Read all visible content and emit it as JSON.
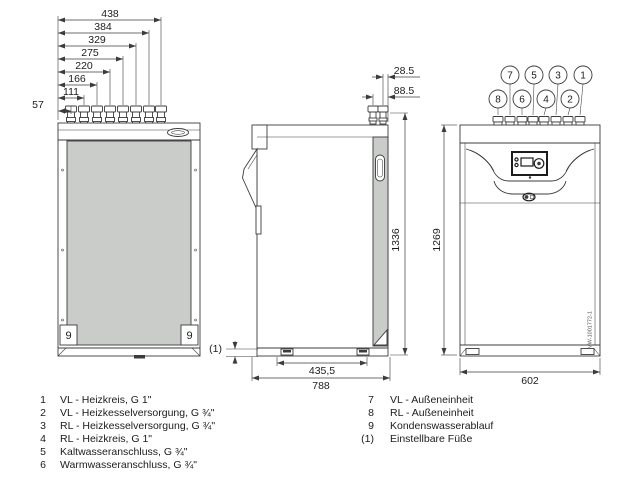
{
  "rear": {
    "dims": [
      "438",
      "384",
      "329",
      "275",
      "220",
      "166",
      "111",
      "57"
    ],
    "corner_left": "9",
    "corner_right": "9"
  },
  "side": {
    "d28": "28.5",
    "d88": "88.5",
    "height": "1336",
    "feet_width": "435,5",
    "depth": "788",
    "foot_note": "(1)"
  },
  "front": {
    "height": "1269",
    "width": "602",
    "upper_callouts": [
      "7",
      "5",
      "3",
      "1"
    ],
    "lower_callouts": [
      "8",
      "6",
      "4",
      "2"
    ],
    "drawing_number": "MW-1001772-1"
  },
  "legend": {
    "left": [
      {
        "num": "1",
        "text": "VL - Heizkreis, G 1\""
      },
      {
        "num": "2",
        "text": "VL - Heizkesselversorgung, G ¾\""
      },
      {
        "num": "3",
        "text": "RL - Heizkesselversorgung, G ¾\""
      },
      {
        "num": "4",
        "text": "RL - Heizkreis, G 1\""
      },
      {
        "num": "5",
        "text": "Kaltwasseranschluss, G ¾\""
      },
      {
        "num": "6",
        "text": "Warmwasseranschluss, G ¾\""
      }
    ],
    "right": [
      {
        "num": "7",
        "text": "VL - Außeneinheit"
      },
      {
        "num": "8",
        "text": "RL - Außeneinheit"
      },
      {
        "num": "9",
        "text": "Kondenswasserablauf"
      },
      {
        "num": "(1)",
        "text": "Einstellbare Füße"
      }
    ]
  }
}
